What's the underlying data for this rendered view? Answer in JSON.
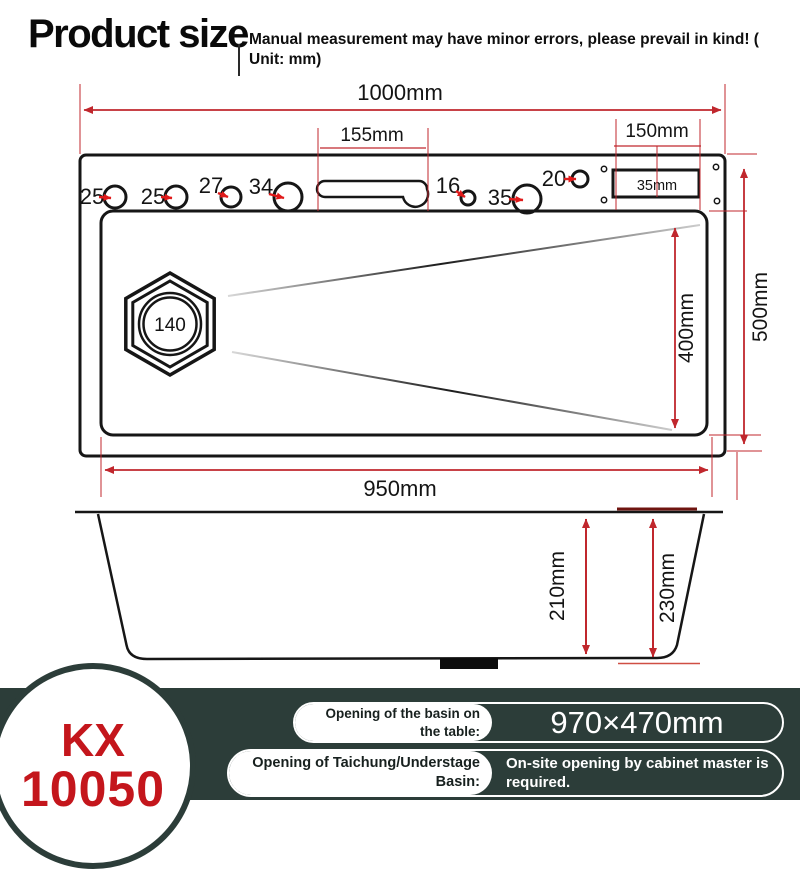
{
  "header": {
    "title": "Product size",
    "note_l1": "Manual measurement may have minor errors, please prevail in kind! (",
    "note_l2": "Unit: mm)"
  },
  "diagram": {
    "dims": {
      "top_width": "1000mm",
      "slot_width": "155mm",
      "right_width": "150mm",
      "rect_width": "35mm",
      "basin_width": "950mm",
      "basin_length": "400mm",
      "overall_depth": "500mm",
      "inner_height": "210mm",
      "outer_height": "230mm"
    },
    "drain_label": "140",
    "hole_labels": [
      "25",
      "25",
      "27",
      "34",
      "16",
      "35",
      "20"
    ]
  },
  "footer": {
    "model_top": "KX",
    "model_bottom": "10050",
    "row1_label_l1": "Opening of the basin on",
    "row1_label_l2": "the table:",
    "row1_value": "970×470mm",
    "row2_label_l1": "Opening of Taichung/Understage",
    "row2_label_l2": "Basin:",
    "row2_value_l1": "On-site opening by cabinet master is",
    "row2_value_l2": "required."
  },
  "colors": {
    "dimension_red": "#c0272d",
    "pointer_red": "#e01a1a",
    "line_black": "#161616",
    "band_dark": "#2c3d39",
    "brand_red": "#c4161c"
  }
}
